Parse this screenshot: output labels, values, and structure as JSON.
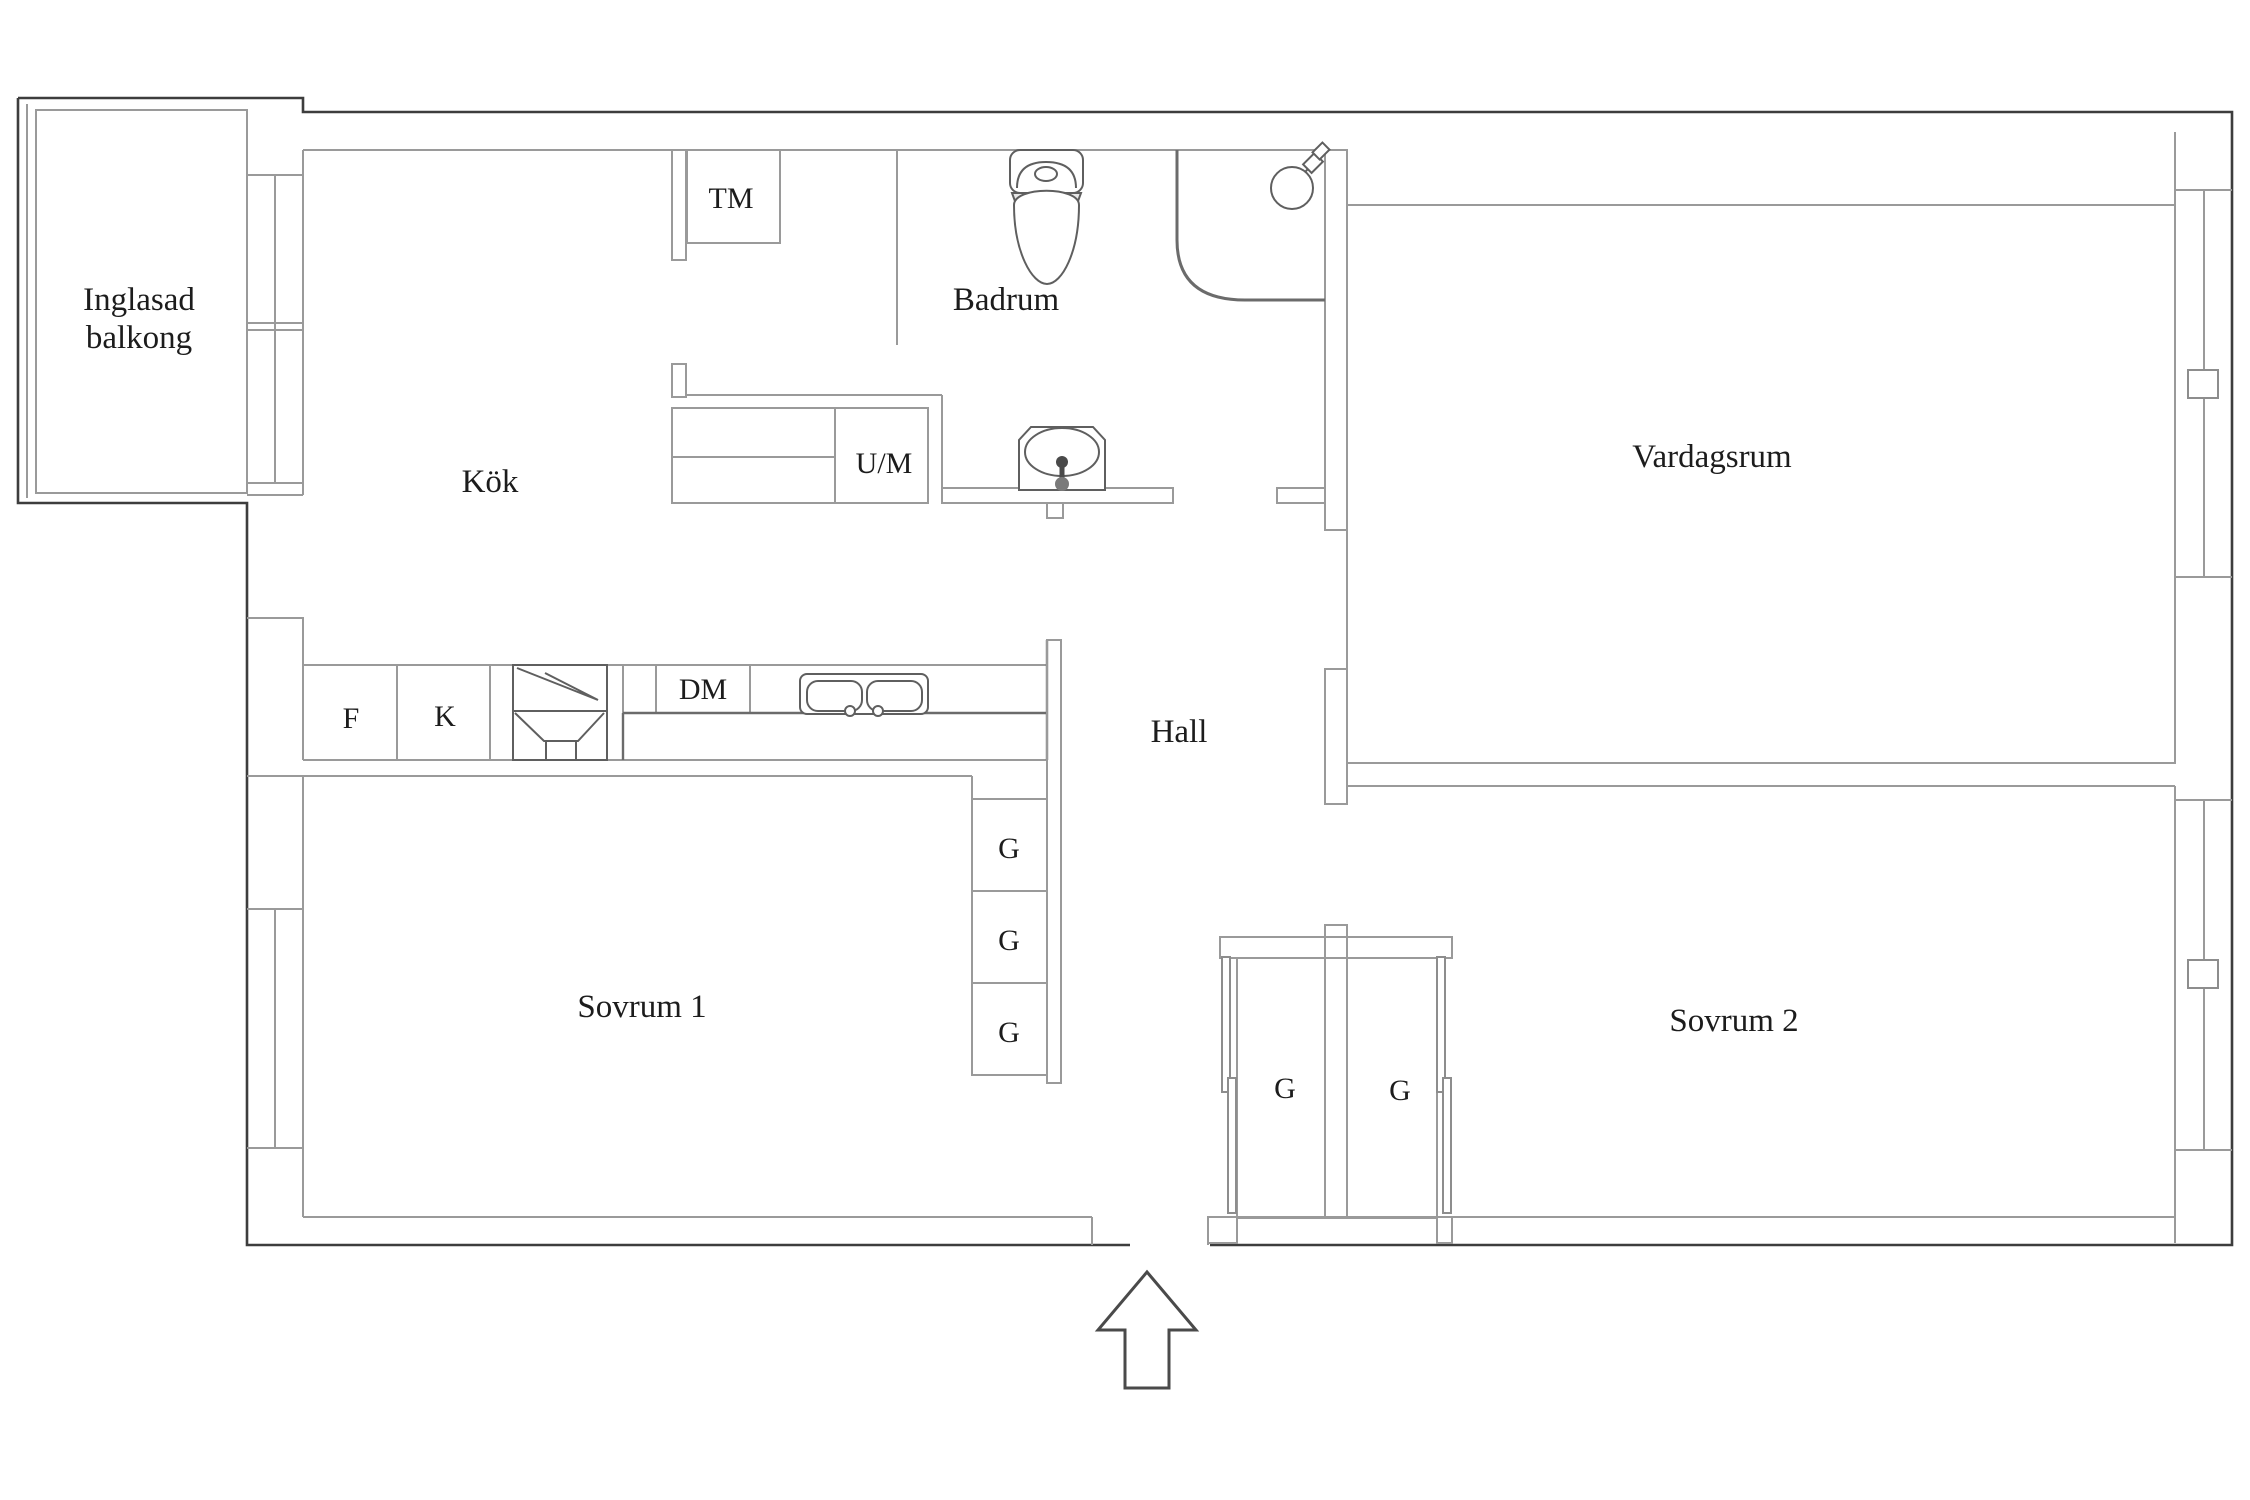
{
  "plan": {
    "title": "apartment-floor-plan",
    "colors": {
      "outer_wall": "#3d3d3d",
      "inner_wall": "#9a9a9a",
      "fixture": "#5f5f5f",
      "text": "#1c1c1c",
      "background": "#ffffff",
      "shade": "#e9e9e9"
    },
    "rooms": {
      "balcony": {
        "label_line1": "Inglasad",
        "label_line2": "balkong"
      },
      "kitchen": {
        "label": "Kök"
      },
      "bathroom": {
        "label": "Badrum"
      },
      "living_room": {
        "label": "Vardagsrum"
      },
      "hall": {
        "label": "Hall"
      },
      "bedroom1": {
        "label": "Sovrum 1"
      },
      "bedroom2": {
        "label": "Sovrum 2"
      }
    },
    "fixtures": {
      "washing_machine": "TM",
      "oven_micro": "U/M",
      "fridge": "F",
      "freezer": "K",
      "dishwasher": "DM",
      "wardrobe1": "G",
      "wardrobe2": "G",
      "wardrobe3": "G",
      "hall_wardrobe_left": "G",
      "hall_wardrobe_right": "G"
    }
  }
}
